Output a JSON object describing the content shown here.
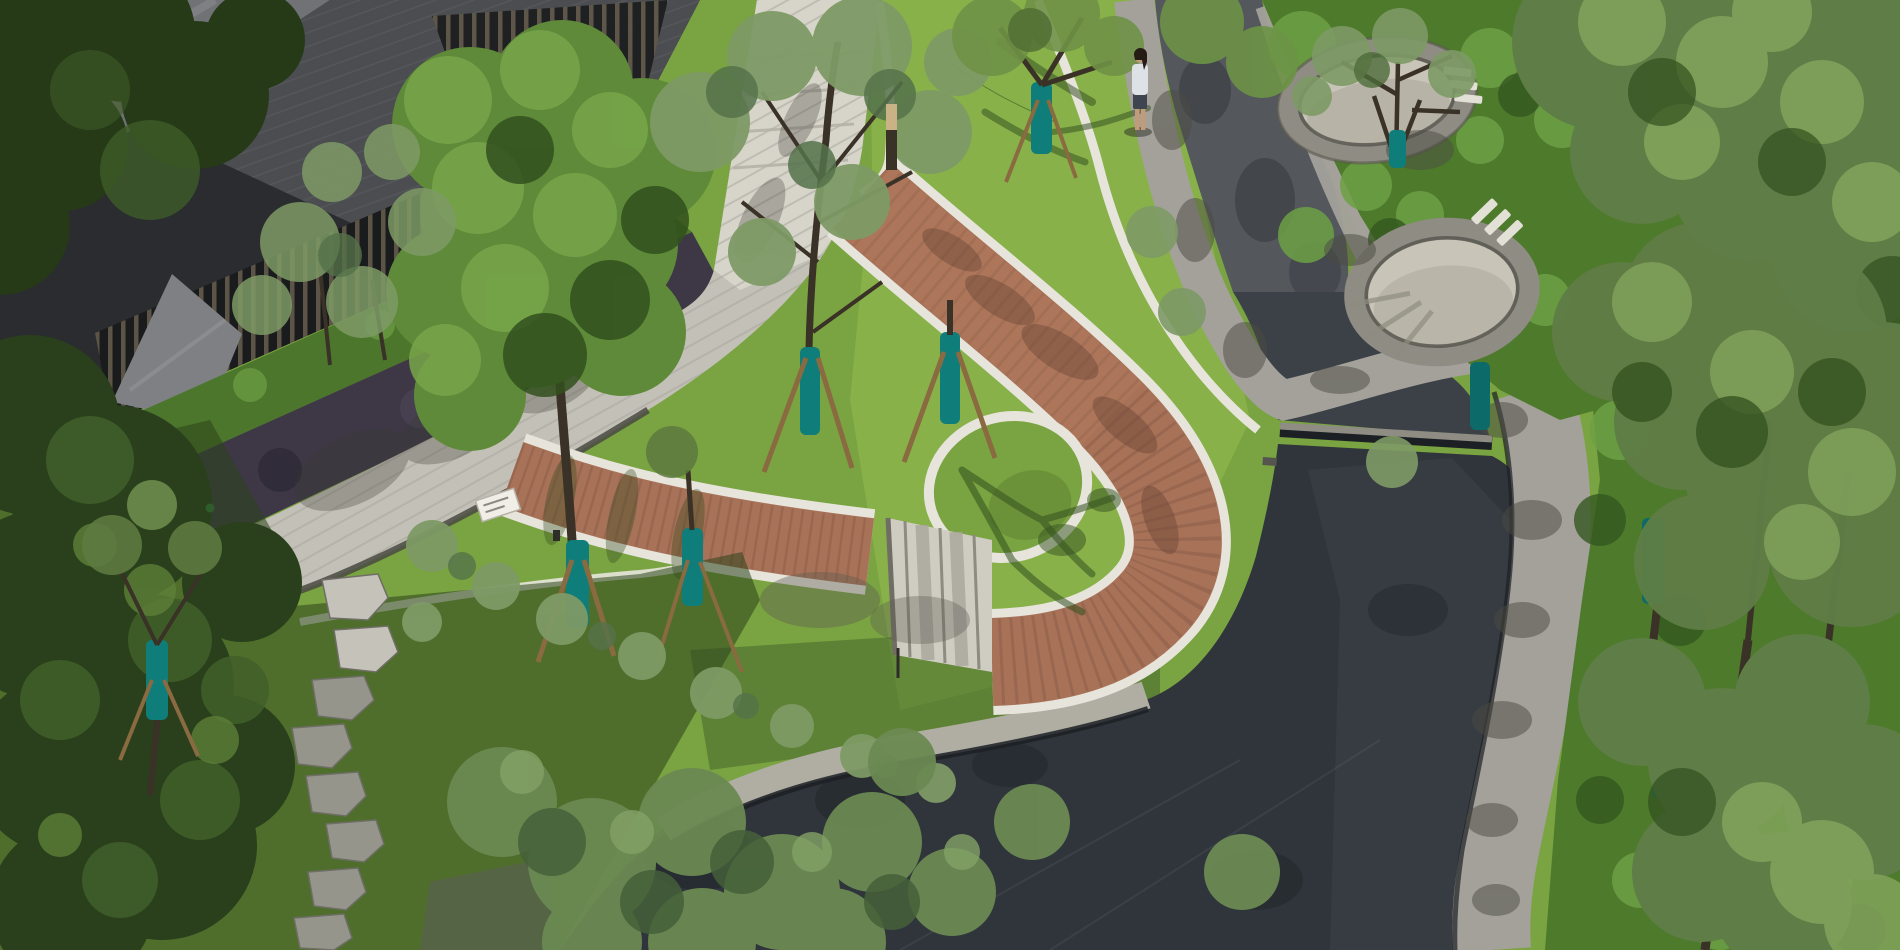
{
  "scene": {
    "type": "aerial-photograph",
    "subject": "landscaped residential courtyard park seen from above",
    "lighting": "strong midday sun, long leaf shadows",
    "features": [
      "building with vertical louver screen at top left",
      "pale stone esplanade with linear paving joints",
      "dark purple groundcover band and green hedge along building",
      "bright lawn with white curved concrete strips",
      "terracotta wood boardwalk loop with white edges and stone stairs",
      "dark reflecting pool with stone weir and stream",
      "two sunken round stone terraces at top right",
      "granite walkways with dappled shade",
      "stepping stones on shaded grass at bottom left",
      "young trees with teal trunk wraps and wooden tripod stakes",
      "one person standing beside the stream path"
    ]
  },
  "objects": {
    "person": {
      "count": 1,
      "top": "light blue-white shirt",
      "hair": "dark",
      "location": "standing on granite path beside stream, upper right of lawn"
    },
    "bollard_light": {
      "count": 1,
      "material": "wood",
      "location": "edge of white walkway"
    },
    "sign_plate": {
      "count": 1,
      "color": "white",
      "location": "on pale esplanade"
    },
    "stepping_stones": {
      "count": 8,
      "location": "shaded grass, bottom left"
    },
    "sunken_terraces": {
      "count": 2,
      "material": "stone ring wall with paved floor"
    },
    "stairs": {
      "treads": 3,
      "location": "between boardwalk arm and lower loop"
    },
    "weir": {
      "count": 1,
      "location": "across dark pool"
    },
    "tree_trunk_wraps": {
      "color_name": "teal",
      "count_visible": 9
    }
  },
  "palette": {
    "lawn_mid": "#7aa341",
    "lawn_bright": "#8db54e",
    "lawn_shade": "#46682c",
    "shadow_green": "#2c441c",
    "white_path": "#e7e5db",
    "plaza": "#c3c1b7",
    "plaza_light": "#dbd8ce",
    "plaza_joint": "#a7a59b",
    "curb": "#4a4a44",
    "boardwalk": "#a87258",
    "boardwalk_dark": "#8a5c48",
    "boardwalk_light": "#bb8162",
    "stair_tread": "#cfccc2",
    "stair_shadow": "#a8a59b",
    "water_stream": "#54585d",
    "water_upper": "#3c4147",
    "water_pool": "#2f353b",
    "water_pool_light": "#3a4147",
    "waterline": "#1c2024",
    "granite": "#a3a19a",
    "granite_dark": "#7b7a74",
    "slope": "#b0ada3",
    "ring_stone": "#8e8c83",
    "terrace_pave": "#c8c4b7",
    "terrace_shadow": "#a9a69a",
    "purple_bed": "#3e3846",
    "hedge": "#4c762c",
    "shrub": "#4e7a2c",
    "shrub_bright": "#6da045",
    "shrub_mid": "#55832f",
    "shrub_dark": "#35571f",
    "canopy_bright": "#78a64a",
    "canopy_mid": "#5f8a39",
    "canopy_dark": "#32501e",
    "canopy_deep": "#263a18",
    "canopy_gray": "#7e9a66",
    "canopy_gray_dark": "#55724a",
    "canopy_right": "#5f7d46",
    "canopy_right_light": "#82a45c",
    "building": "#2a2c2f",
    "roof": "#707276",
    "paving": "#4b4d50",
    "louver": "#5f5748",
    "louver_bg": "#1a1b1d",
    "ramp": "#7e8084",
    "trunk": "#3a3127",
    "stake": "#8a6a40",
    "teal": "#0f7d7a",
    "teal_dark": "#0c6a68",
    "tan_hedge": "#a89274",
    "stone_step_light": "#c5c3b9",
    "stone_step": "#96958c",
    "person_top": "#dde2e6",
    "person_skin": "#c29b79",
    "person_hair": "#241c15",
    "person_skirt": "#3e4450",
    "sign": "#f0eee6"
  }
}
